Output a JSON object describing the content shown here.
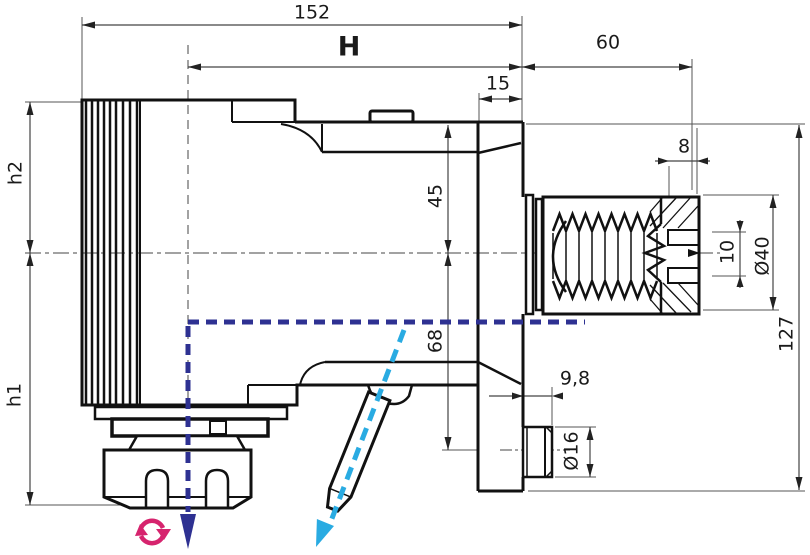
{
  "drawing": {
    "subject": "tool-holder-technical-drawing",
    "dims": {
      "d152": "152",
      "H": "H",
      "d60": "60",
      "d15": "15",
      "d8": "8",
      "d45": "45",
      "d68": "68",
      "h2": "h2",
      "h1": "h1",
      "d98": "9,8",
      "d16": "Ø16",
      "d10": "10",
      "d40": "Ø40",
      "d127": "127"
    },
    "colors": {
      "outline": "#111111",
      "dimension_lines": "#444444",
      "coolant_axis_navy": "#2e3192",
      "pin_axis_cyan": "#29abe2",
      "rotation_pink": "#d6246e"
    },
    "icons": {
      "rotation_icon": "spindle-rotation",
      "down_arrow_icon": "tool-axis-direction",
      "diagonal_arrow_icon": "clamp-pin-direction"
    }
  }
}
